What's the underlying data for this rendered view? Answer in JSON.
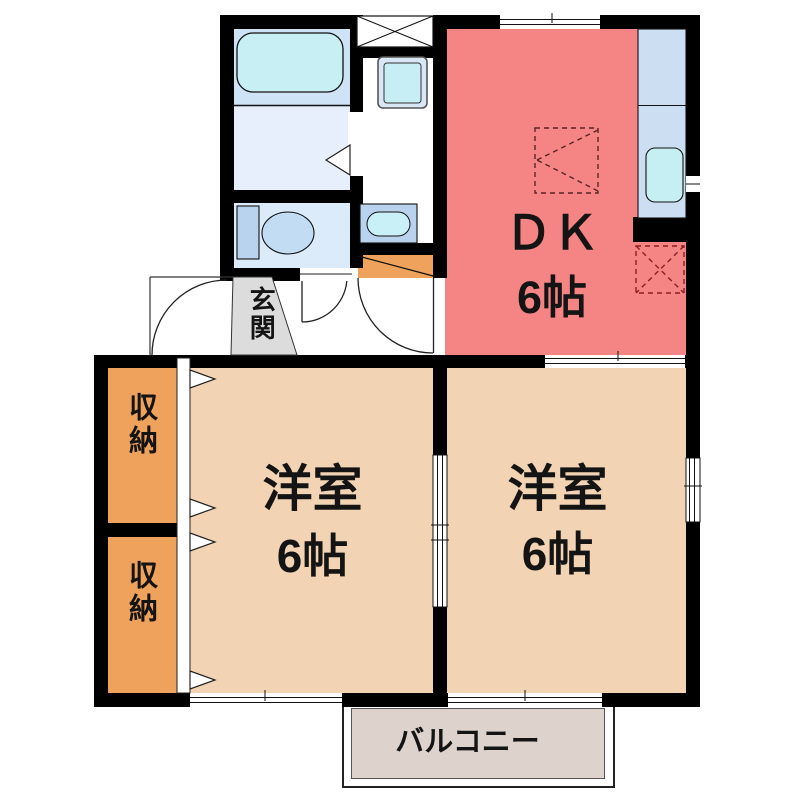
{
  "plan_title": "apartment-floorplan",
  "rooms": {
    "dk": {
      "label": "ＤＫ",
      "size": "6帖",
      "color": "#f58585"
    },
    "western_left": {
      "label": "洋室",
      "size": "6帖",
      "color": "#f2d4b4"
    },
    "western_right": {
      "label": "洋室",
      "size": "6帖",
      "color": "#f2d4b4"
    },
    "closet_upper": {
      "label": "収納",
      "color": "#efa25b"
    },
    "closet_lower": {
      "label": "収納",
      "color": "#efa25b"
    },
    "entrance": {
      "label": "玄関",
      "color": "#dcdcdc"
    },
    "balcony": {
      "label": "バルコニー",
      "color": "#ddd3cc"
    },
    "bathroom": {
      "color": "#cfe3f7"
    },
    "washroom": {
      "color": "#e6effb"
    },
    "toilet_room": {
      "color": "#dcebf9"
    }
  },
  "colors": {
    "wall": "#000000",
    "bathtub": "#c8eff3",
    "kitchen_counter": "#ccdef2",
    "kitchen_sink": "#c6eff3",
    "washing_machine": "#c6eef4",
    "washbasin": "#b9d2ee",
    "toilet_fixture": "#c2dcf4",
    "entrance_step": "#efa25b",
    "dashed_marker_red": "#8b1e1e",
    "dashed_marker_dark": "#3a3a3a"
  }
}
